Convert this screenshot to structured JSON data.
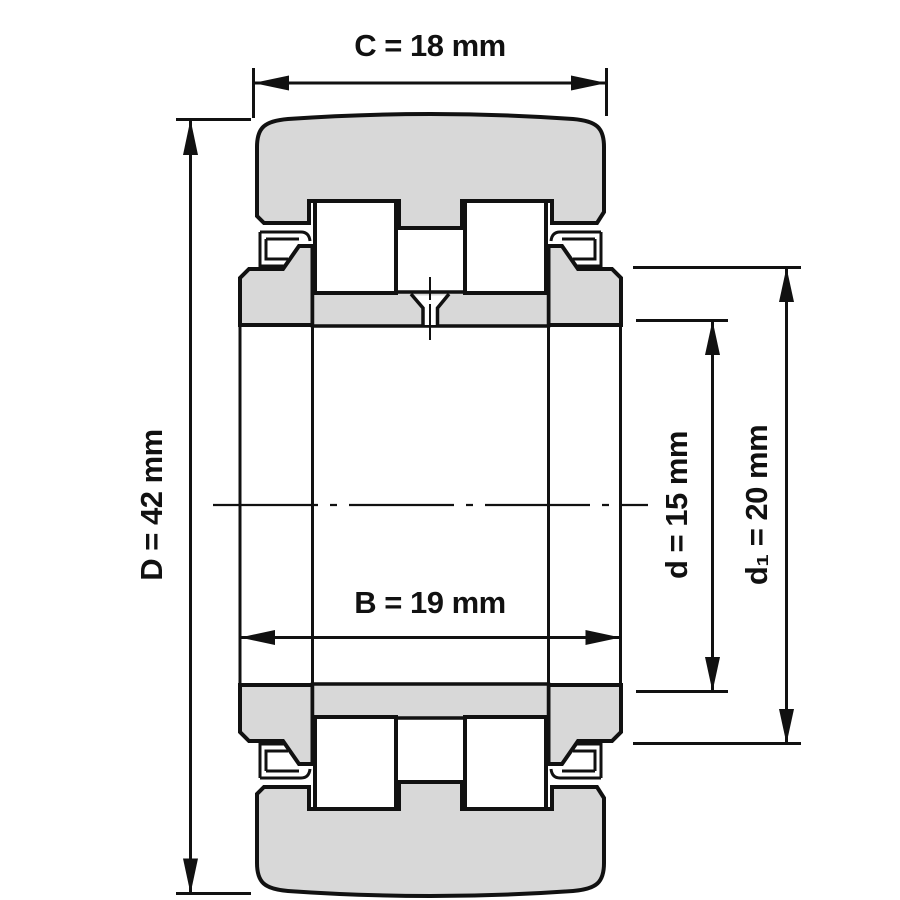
{
  "drawing": {
    "type": "bearing-cross-section",
    "description_visible_text_only": true,
    "dimensions": {
      "C": {
        "label": "C = 18 mm"
      },
      "D": {
        "label": "D = 42 mm"
      },
      "B": {
        "label": "B = 19 mm"
      },
      "d": {
        "label": "d = 15 mm"
      },
      "d1": {
        "label": "d₁ = 20 mm"
      }
    },
    "colors": {
      "part_fill": "#d8d8d8",
      "line": "#111111",
      "background": "#ffffff"
    }
  }
}
